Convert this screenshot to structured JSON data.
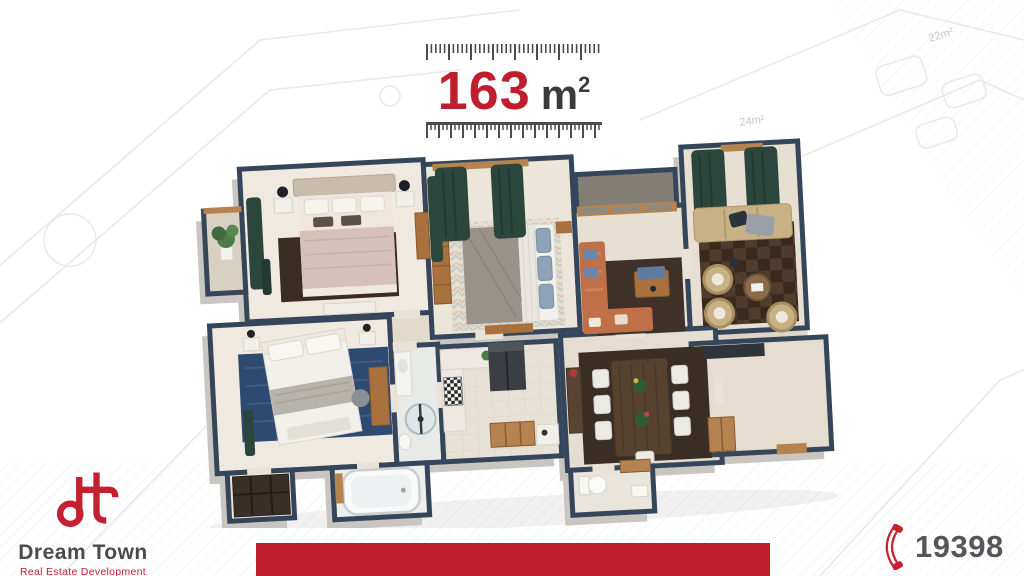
{
  "header": {
    "area_value": "163",
    "area_unit_base": "m",
    "area_unit_sup": "2"
  },
  "background": {
    "faint_area_labels": [
      "22m²",
      "24m²"
    ]
  },
  "logo": {
    "monogram": "dt",
    "brand": "Dream Town",
    "tagline": "Real Estate Development"
  },
  "contact": {
    "phone_number": "19398"
  },
  "colors": {
    "accent_red": "#be1e2d",
    "logo_red": "#c32032",
    "dark_text": "#3b3b3d",
    "brand_gray": "#4a4b4d",
    "phone_gray": "#55565a",
    "wall_slate": "#36465a",
    "floor_beige": "#e9e2d6",
    "curtain_green": "#2b463c",
    "rug_blue": "#2e4a70",
    "rug_brown": "#3b2c22",
    "wood": "#b5834f",
    "sofa_terracotta": "#bf7048",
    "sofa_beige": "#c8b184"
  }
}
